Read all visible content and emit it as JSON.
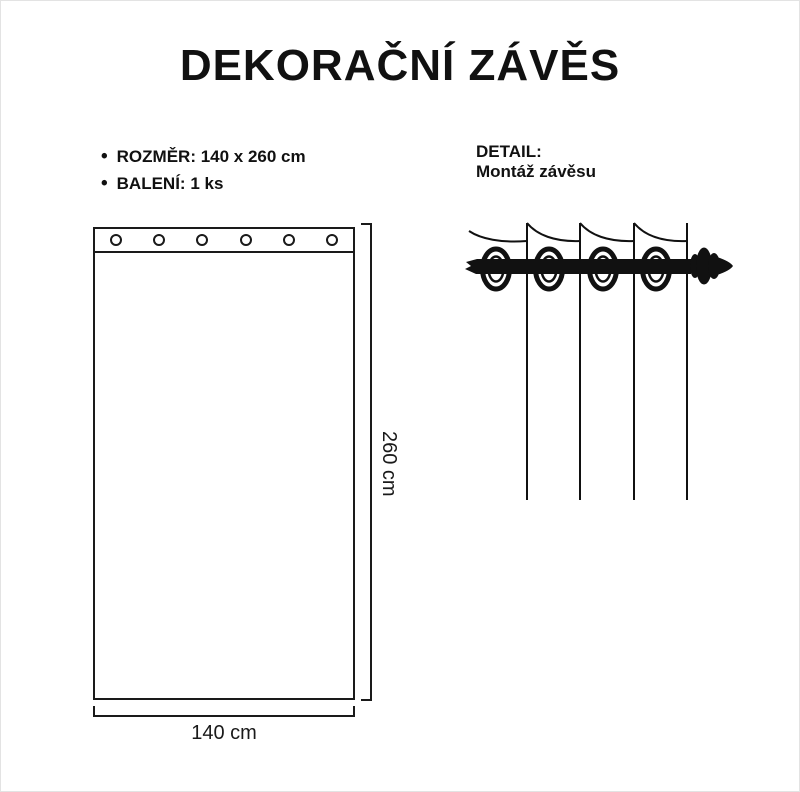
{
  "title": "DEKORAČNÍ ZÁVĚS",
  "specs": {
    "bullet": "•",
    "items": [
      {
        "label": "ROZMĚR: 140 x 260 cm"
      },
      {
        "label": "BALENÍ: 1 ks"
      }
    ]
  },
  "detail": {
    "heading": "DETAIL:",
    "subheading": "Montáž závěsu"
  },
  "diagram": {
    "width_label": "140 cm",
    "height_label": "260 cm",
    "grommet_count": 6,
    "detail_ring_count": 4
  },
  "colors": {
    "ink": "#111111",
    "line": "#1a1a1a",
    "background": "#ffffff"
  }
}
